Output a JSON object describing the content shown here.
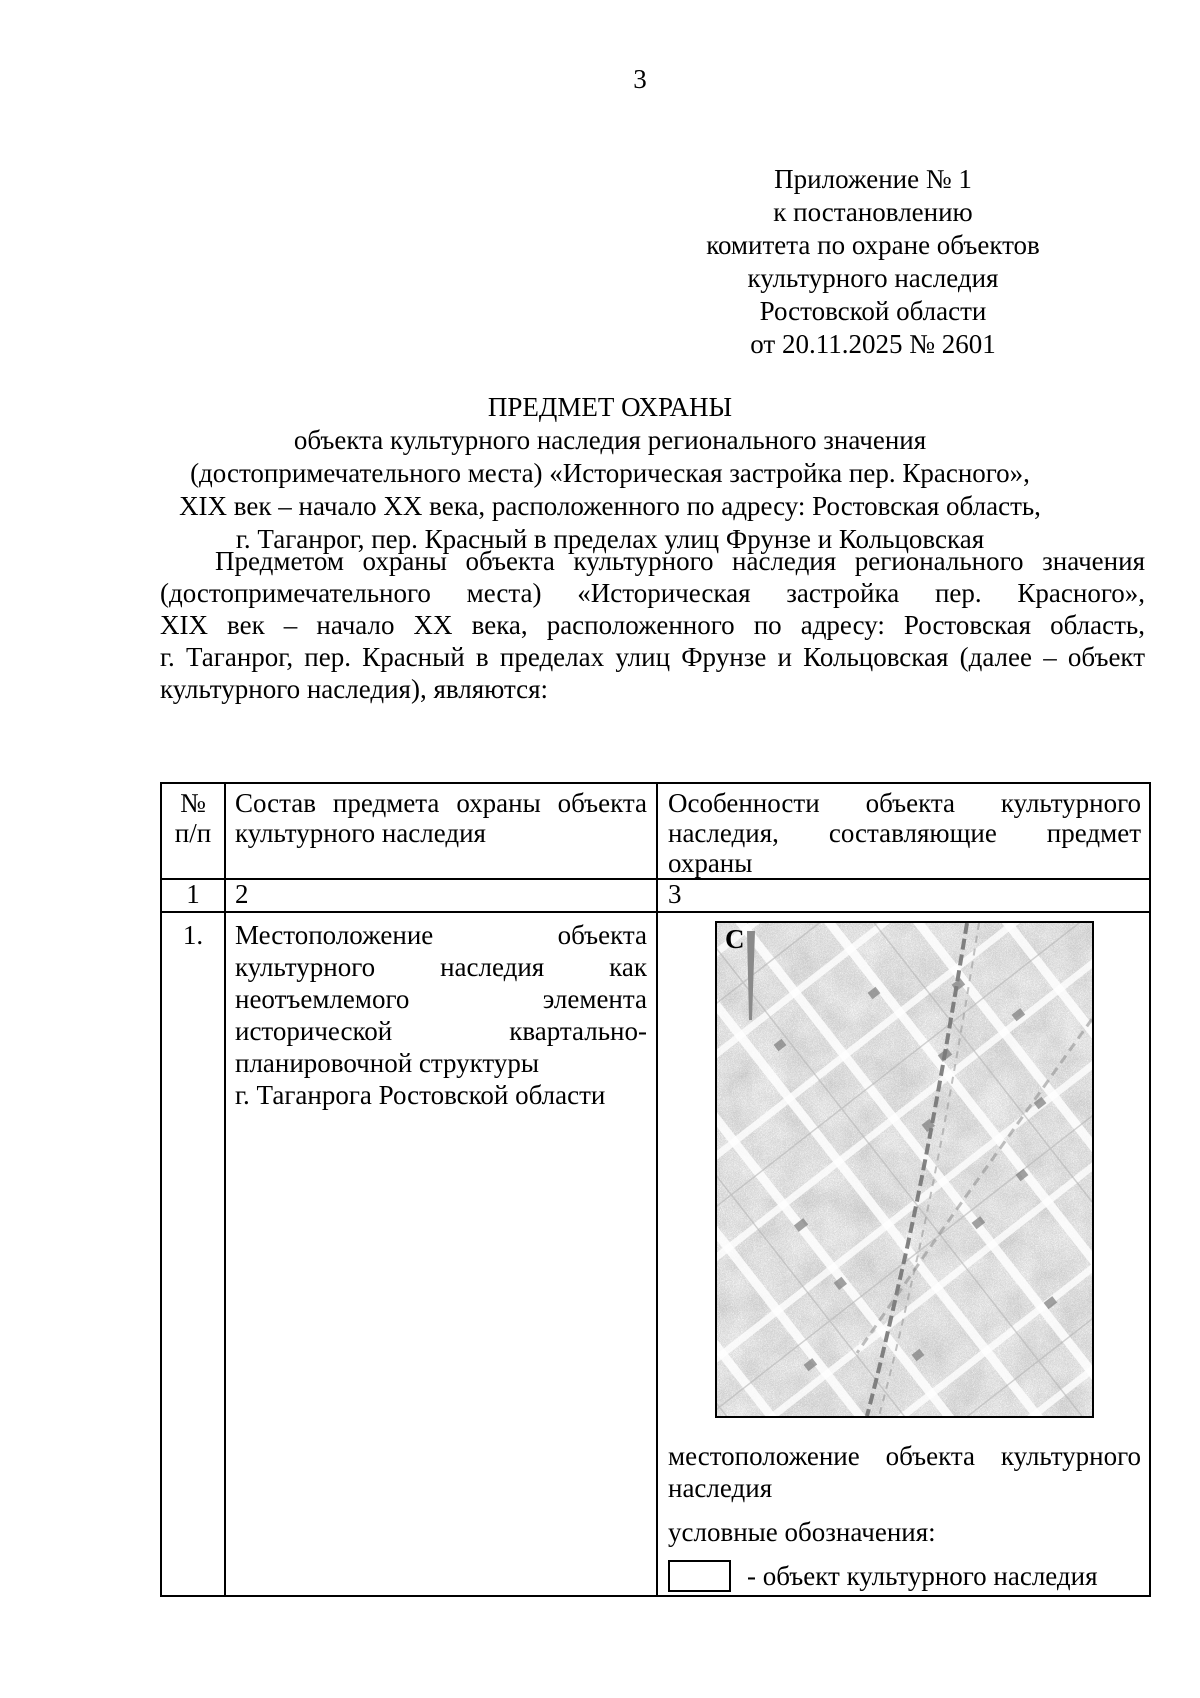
{
  "page_number": "3",
  "annex_block": {
    "lines": [
      "Приложение № 1",
      "к постановлению",
      "комитета по охране объектов",
      "культурного наследия",
      "Ростовской области",
      "от 20.11.2025 № 2601"
    ]
  },
  "title_block": {
    "lines": [
      "ПРЕДМЕТ ОХРАНЫ",
      "объекта культурного наследия регионального значения",
      "(достопримечательного места) «Историческая застройка пер. Красного»,",
      "XIX век – начало XX века, расположенного по адресу: Ростовская область,",
      "г. Таганрог, пер. Красный в пределах улиц Фрунзе и Кольцовская"
    ]
  },
  "intro": {
    "lines": [
      "Предметом охраны объекта культурного наследия регионального значения",
      "(достопримечательного места) «Историческая застройка пер. Красного»,",
      "XIX век – начало XX века, расположенного по адресу: Ростовская область,",
      "г. Таганрог, пер. Красный в пределах улиц Фрунзе и Кольцовская (далее – объект",
      "культурного наследия), являются:"
    ]
  },
  "table": {
    "header": {
      "col1_line1": "№",
      "col1_line2": "п/п",
      "col2": "Состав предмета охраны объекта культурного наследия",
      "col3_lines": [
        "Особенности объекта культурного",
        "наследия, составляющие предмет",
        "охраны"
      ]
    },
    "numbering": [
      "1",
      "2",
      "3"
    ],
    "row1": {
      "num": "1.",
      "composition_lines": [
        "Местоположение объекта",
        "культурного наследия как",
        "неотъемлемого элемента",
        "исторической квартально-",
        "планировочной структуры",
        "г. Таганрога Ростовской области"
      ],
      "map": {
        "north_label": "С"
      },
      "caption_lines": [
        "местоположение объекта культурного",
        "наследия"
      ],
      "legend_title": "условные обозначения:",
      "legend_item": "- объект культурного наследия"
    }
  }
}
